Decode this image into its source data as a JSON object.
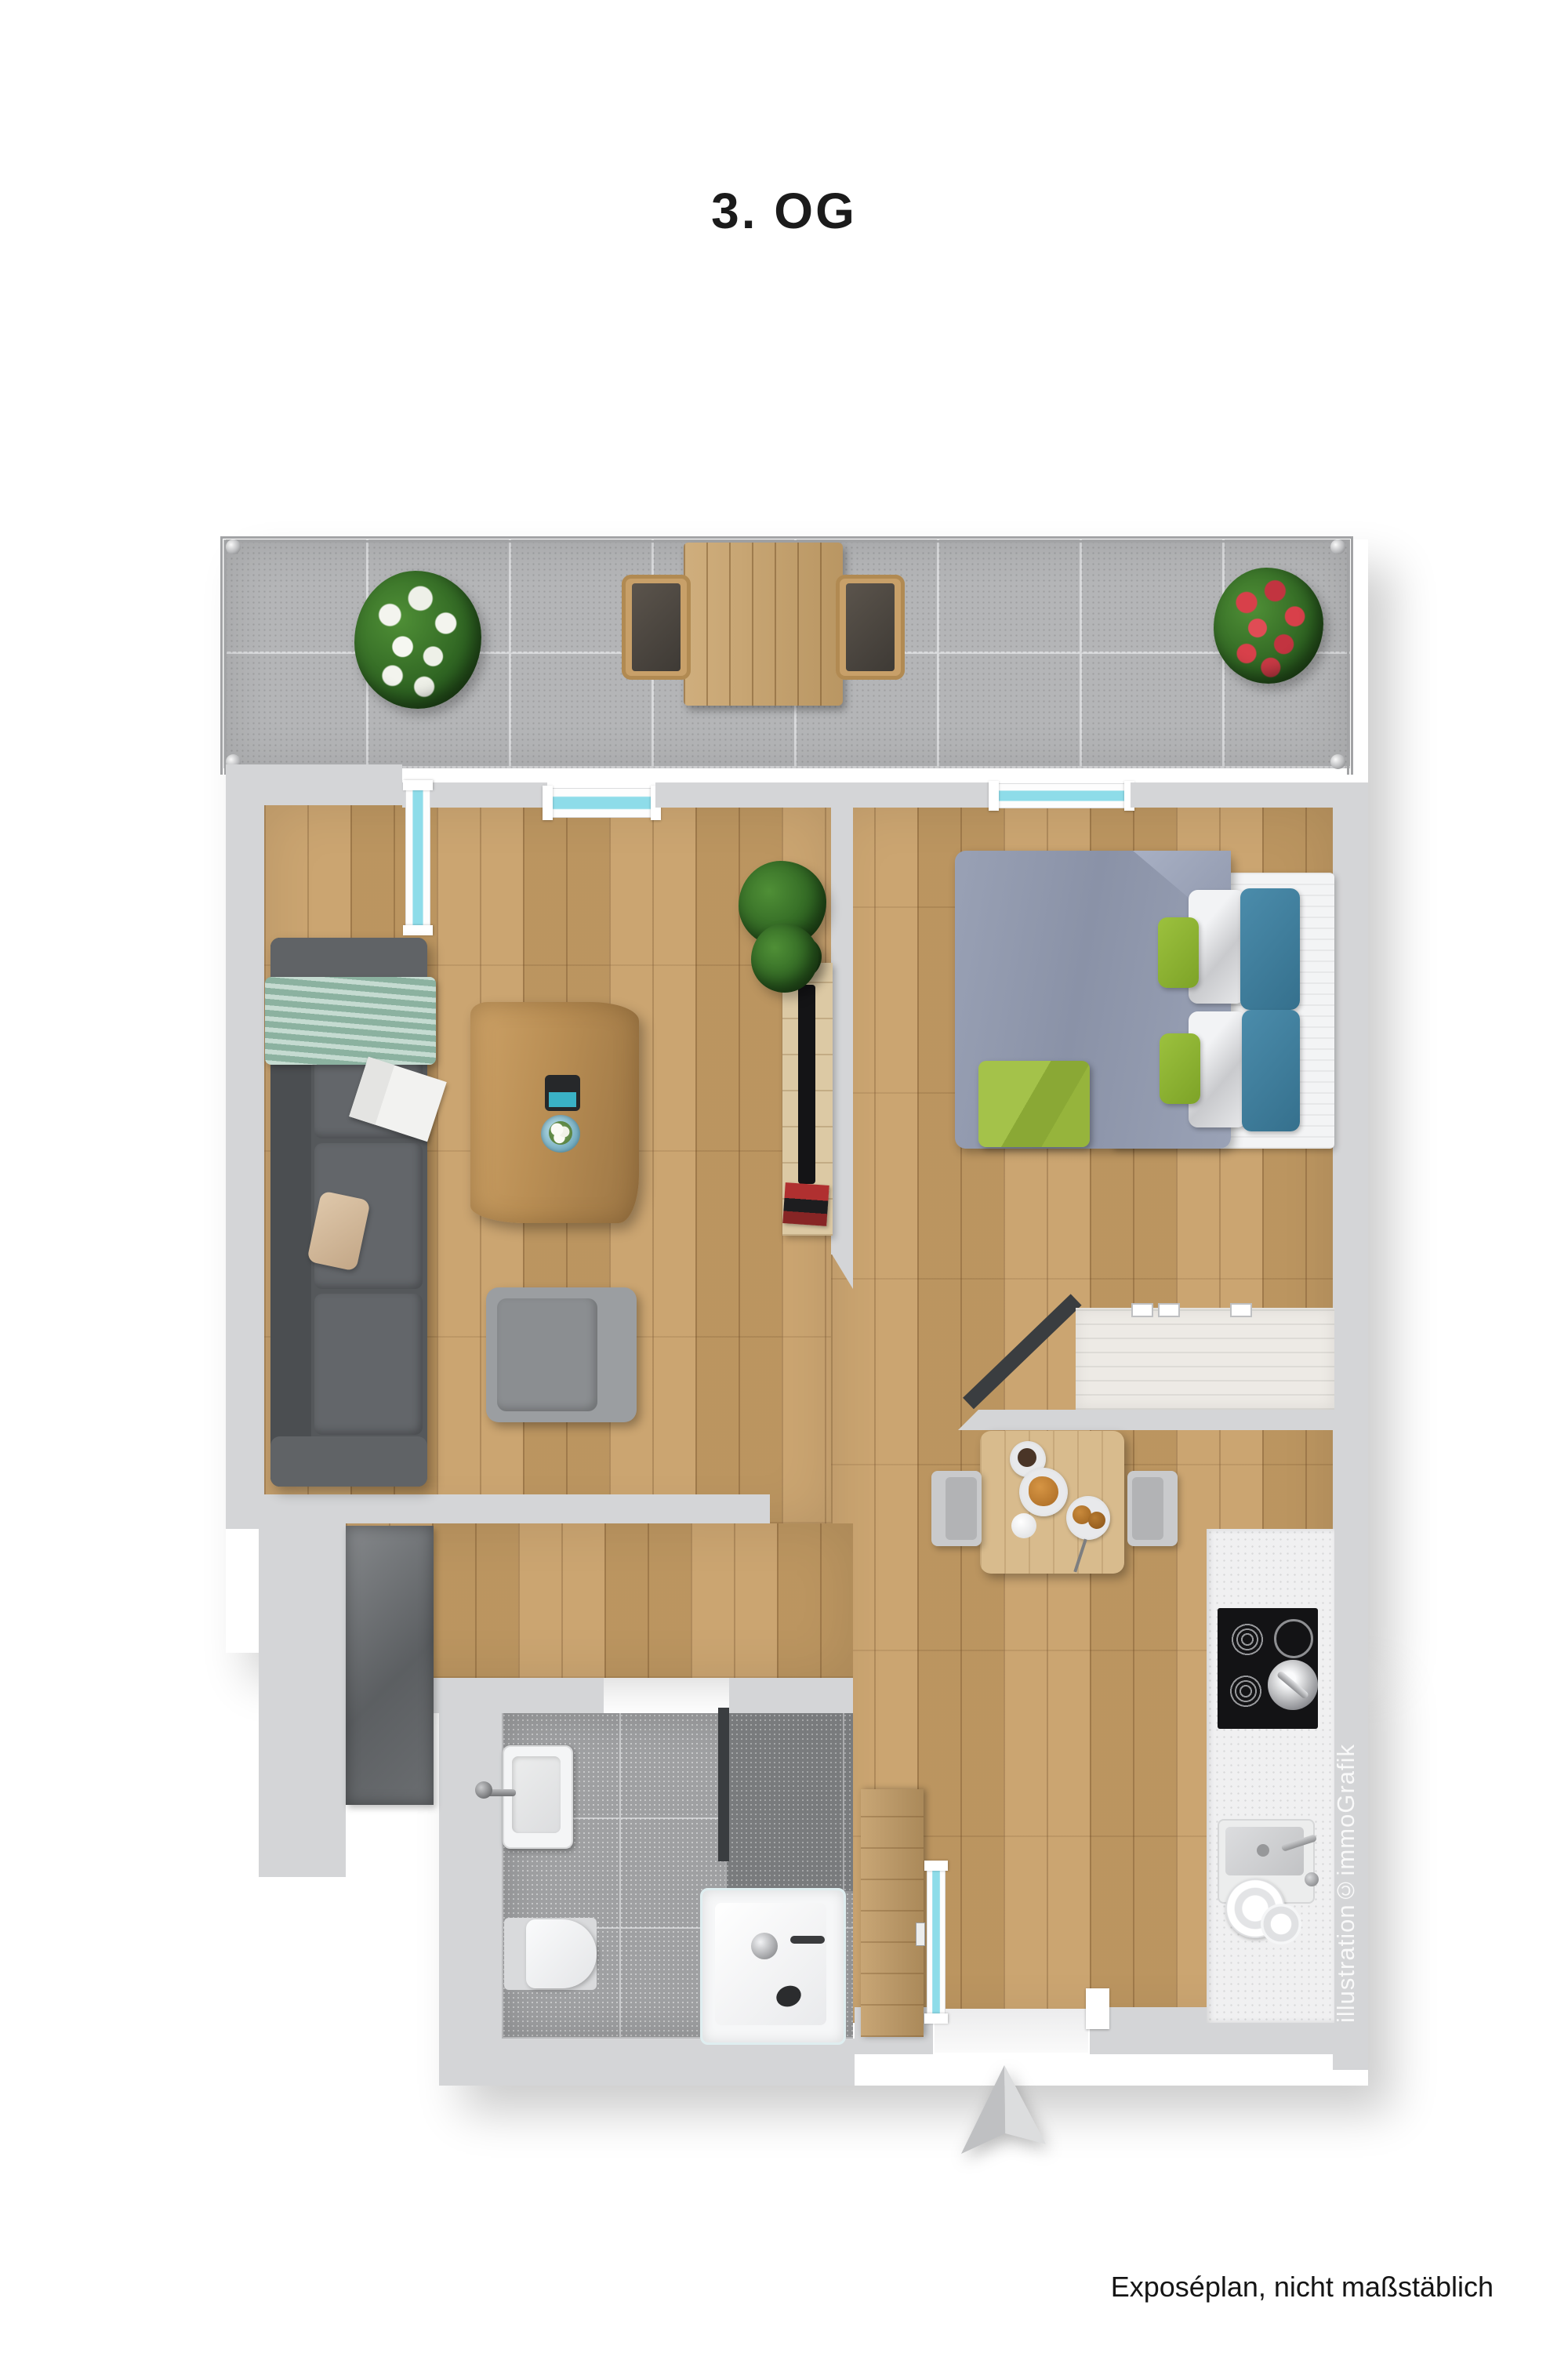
{
  "header": {
    "title": "3. OG"
  },
  "footer": {
    "note": "Exposéplan, nicht maßstäblich"
  },
  "plan": {
    "watermark": "illustration©immoGrafik",
    "icons": [
      "north-arrow-icon"
    ],
    "colors": {
      "wall": "#d4d5d7",
      "dark_wall": "#3a3d40",
      "window_glazing": "#8edce9",
      "wood_floor": "#c79e66",
      "balcony_tile": "#b4b5b7",
      "bath_tile": "#9fa0a2",
      "kitchen_counter": "#f0f0f1",
      "sofa_gray": "#55585b",
      "blanket_mint": "#a6c8b8",
      "duvet_blue_gray": "#8d95aa",
      "pillow_blue": "#3f7f9e",
      "pillow_green": "#8fb832",
      "plant_green": "#2d6221",
      "flowers_white": "#f3f4ee",
      "flowers_red": "#d8404a"
    }
  }
}
